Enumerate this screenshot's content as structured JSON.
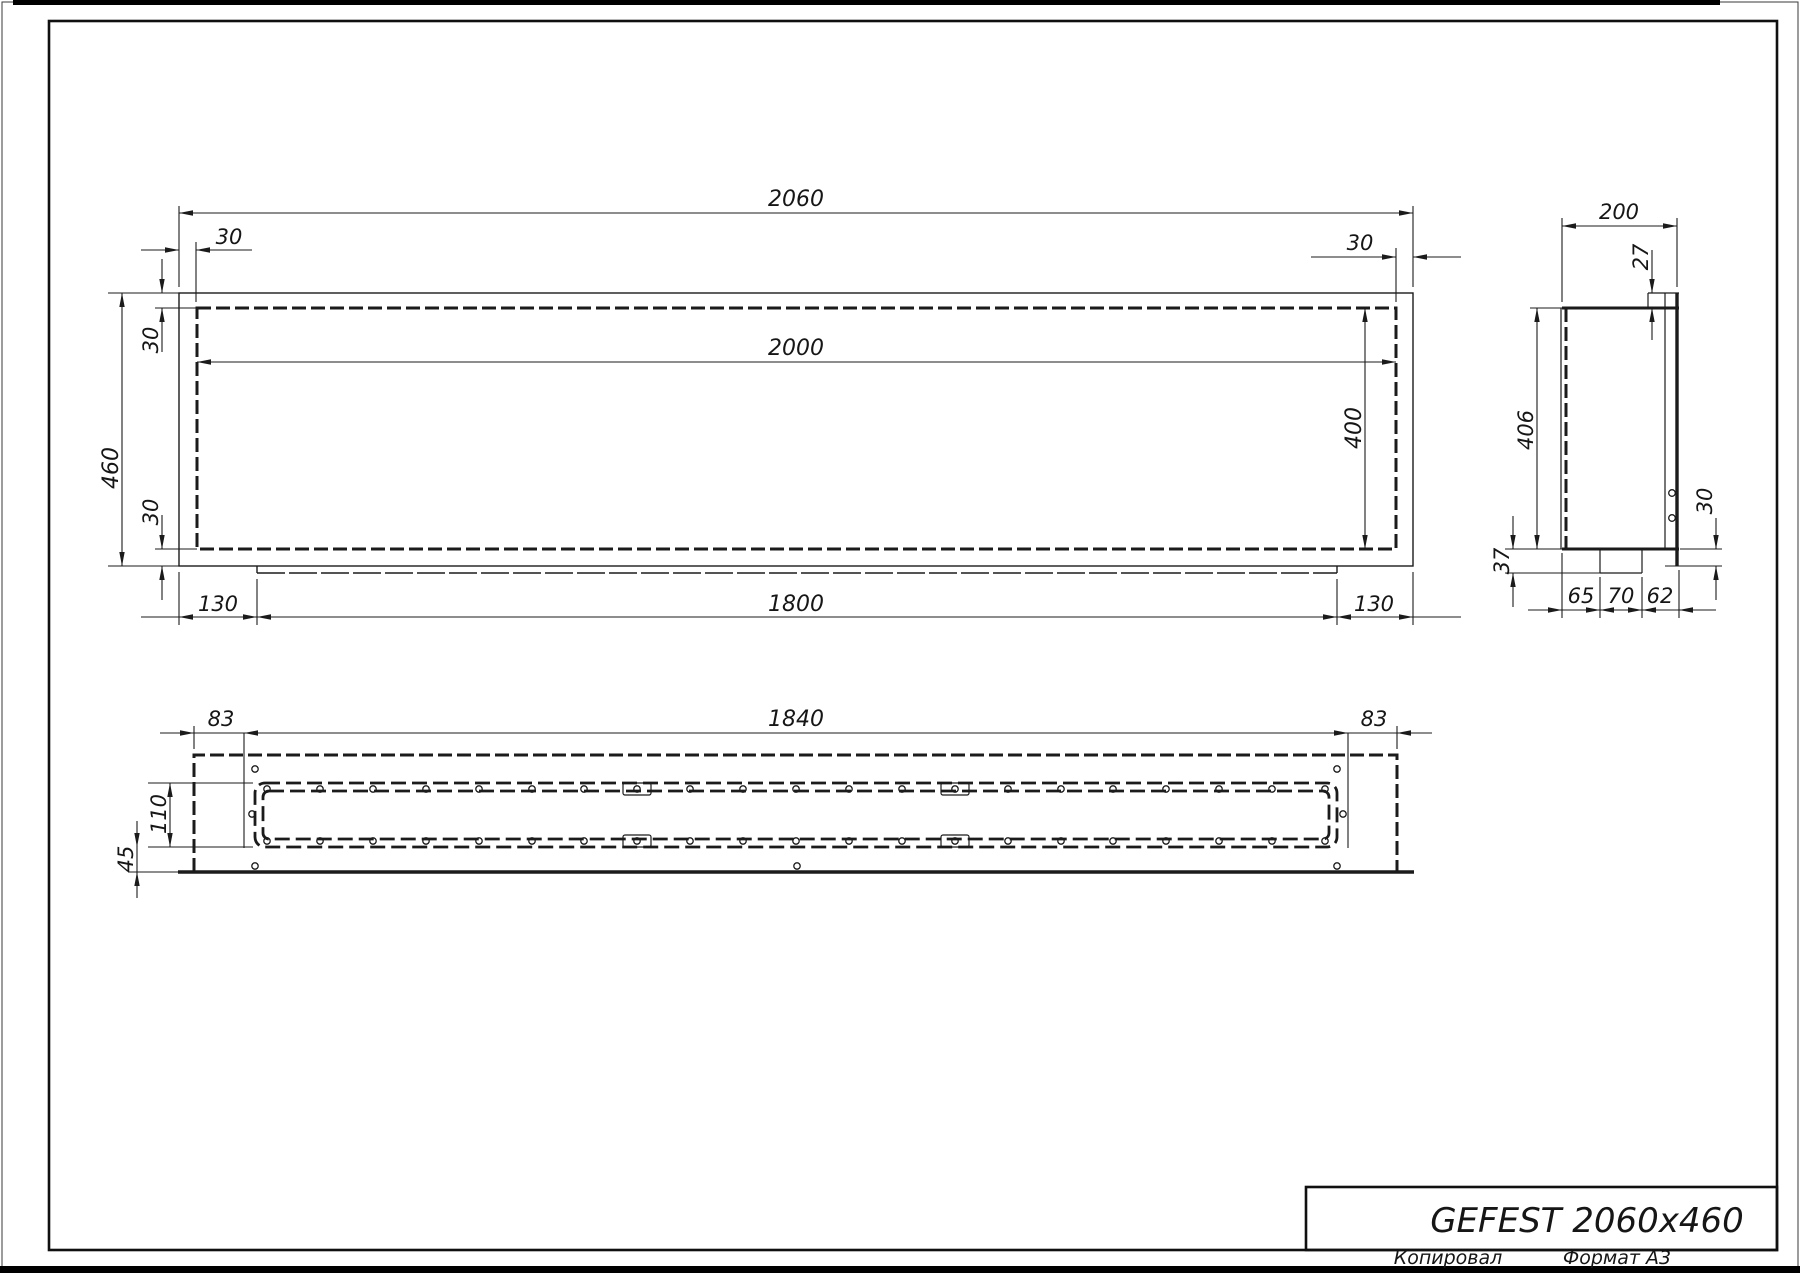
{
  "drawing": {
    "views": {
      "front": {
        "labels": {
          "total_width": "2060",
          "inner_width": "2000",
          "total_height": "460",
          "inner_height": "400",
          "wall_top_left": "30",
          "wall_top_right": "30",
          "wall_side_top": "30",
          "wall_side_bottom": "30",
          "bottom_left_offset": "130",
          "bottom_length": "1800",
          "bottom_right_offset": "130"
        }
      },
      "side": {
        "labels": {
          "depth": "200",
          "top_lip": "27",
          "height": "406",
          "tab_drop": "37",
          "front_edge_drop": "30",
          "seg_left": "65",
          "seg_mid": "70",
          "seg_right": "62"
        }
      },
      "bottom": {
        "labels": {
          "left_margin": "83",
          "mount_length": "1840",
          "right_margin": "83",
          "slot_width": "110",
          "edge_offset": "45"
        }
      }
    },
    "title_block": {
      "model": "GEFEST 2060x460"
    },
    "footer": {
      "copied_by": "Копировал",
      "format": "Формат A3"
    }
  }
}
